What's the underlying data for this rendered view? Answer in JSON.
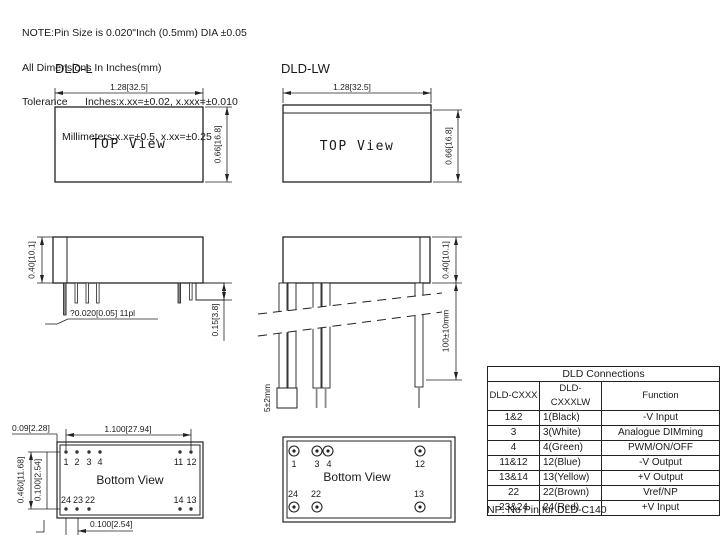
{
  "note": {
    "line1": "NOTE:Pin Size is 0.020\"Inch (0.5mm) DIA ±0.05",
    "line2": "All Dimensions In Inches(mm)",
    "line3": "Tolerance      Inches:x.xx=±0.02, x.xxx=±0.010",
    "line4": "Millimeters:x.x=±0.5, x.xx=±0.25"
  },
  "dld_l": {
    "label": "DLD-L",
    "top_view": {
      "text": "TOP View",
      "width_dim": "1.28[32.5]",
      "height_dim": "0.66[16.8]"
    },
    "side_view": {
      "height_dim": "0.40[10.1]",
      "pin_note": "?0.020[0.05] 11pl",
      "pin_length_dim": "0.15[3.8]"
    },
    "bottom_view": {
      "text": "Bottom View",
      "edge_offset_dim": "0.09[2.28]",
      "pin_span_dim": "1.100[27.94]",
      "row_span_dim": "0.460[11.68]",
      "row_pitch_dim": "0.100[2.54]",
      "pin_pitch_dim": "0.100[2.54]",
      "top_pins": [
        "1",
        "2",
        "3",
        "4",
        "11",
        "12"
      ],
      "bottom_pins": [
        "24",
        "23",
        "22",
        "14",
        "13"
      ]
    }
  },
  "dld_lw": {
    "label": "DLD-LW",
    "top_view": {
      "text": "TOP View",
      "width_dim": "1.28[32.5]",
      "height_dim": "0.66[16.8]"
    },
    "side_view": {
      "height_dim": "0.40[10.1]",
      "wire_length_dim": "100±10mm",
      "strip_length_dim": "5±2mm"
    },
    "bottom_view": {
      "text": "Bottom View",
      "top_pins": [
        "1",
        "3",
        "4",
        "12"
      ],
      "bottom_pins": [
        "24",
        "22",
        "13"
      ]
    }
  },
  "table": {
    "title": "DLD Connections",
    "headers": [
      "DLD-CXXX",
      "DLD-CXXXLW",
      "Function"
    ],
    "rows": [
      [
        "1&2",
        "1(Black)",
        "-V Input"
      ],
      [
        "3",
        "3(White)",
        "Analogue DIMming"
      ],
      [
        "4",
        "4(Green)",
        "PWM/ON/OFF"
      ],
      [
        "11&12",
        "12(Blue)",
        "-V Output"
      ],
      [
        "13&14",
        "13(Yellow)",
        "+V Output"
      ],
      [
        "22",
        "22(Brown)",
        "Vref/NP"
      ],
      [
        "23&24",
        "24(Red)",
        "+V Input"
      ]
    ],
    "footnote": "NP: No Pin for DLD-C140"
  },
  "colors": {
    "line": "#222222",
    "text": "#1a1a1a",
    "pin_fill": "#8a8a8a",
    "background": "#ffffff"
  }
}
